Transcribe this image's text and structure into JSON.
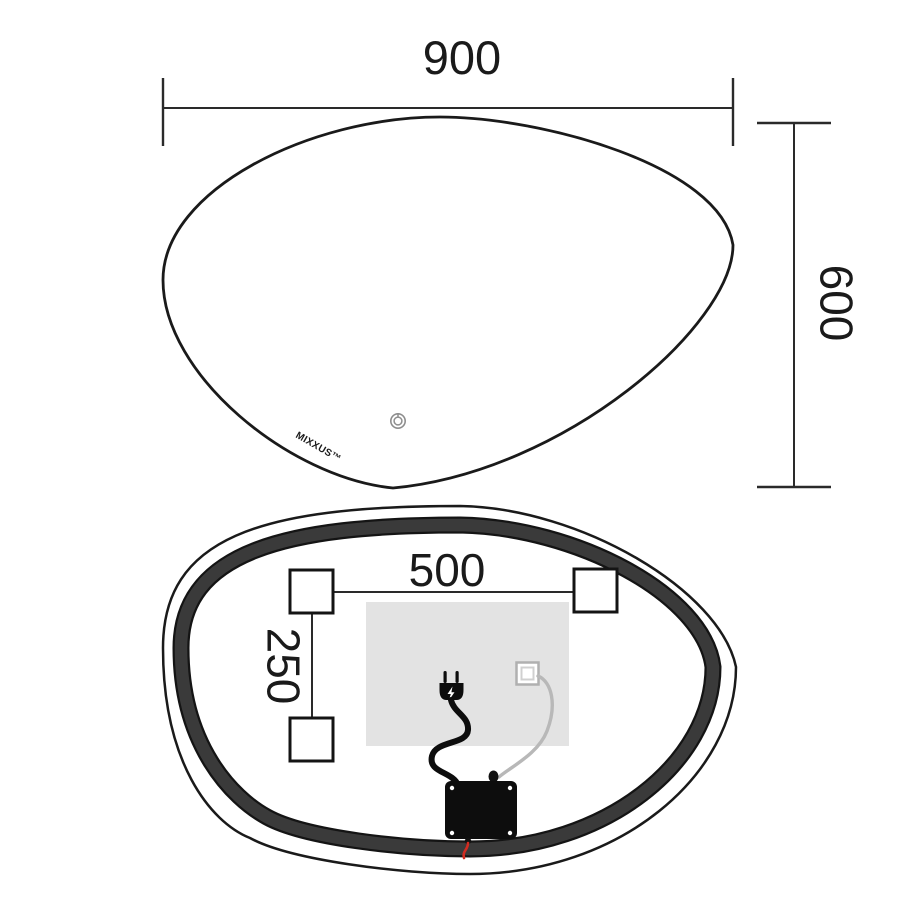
{
  "page": {
    "background": "#ffffff",
    "drawing_color": "#1a1a1a"
  },
  "front_view": {
    "dimension_width": "900",
    "dimension_height": "600",
    "brand_logo": "MIXXUS™"
  },
  "rear_view": {
    "dimension_mount_width": "500",
    "dimension_mount_height": "250"
  },
  "colors": {
    "outline": "#1a1a1a",
    "led_band_fill": "#3a3a3a",
    "led_band_edge": "#141414",
    "heating_pad": "#e3e3e3",
    "cable_gray": "#b8b8b8",
    "connector_border": "#b0b0b0",
    "connector_inner_border": "#d0d0d0",
    "wire_red": "#d22b20",
    "icon_gray": "#8e8e8e",
    "component_black": "#0d0d0d"
  }
}
